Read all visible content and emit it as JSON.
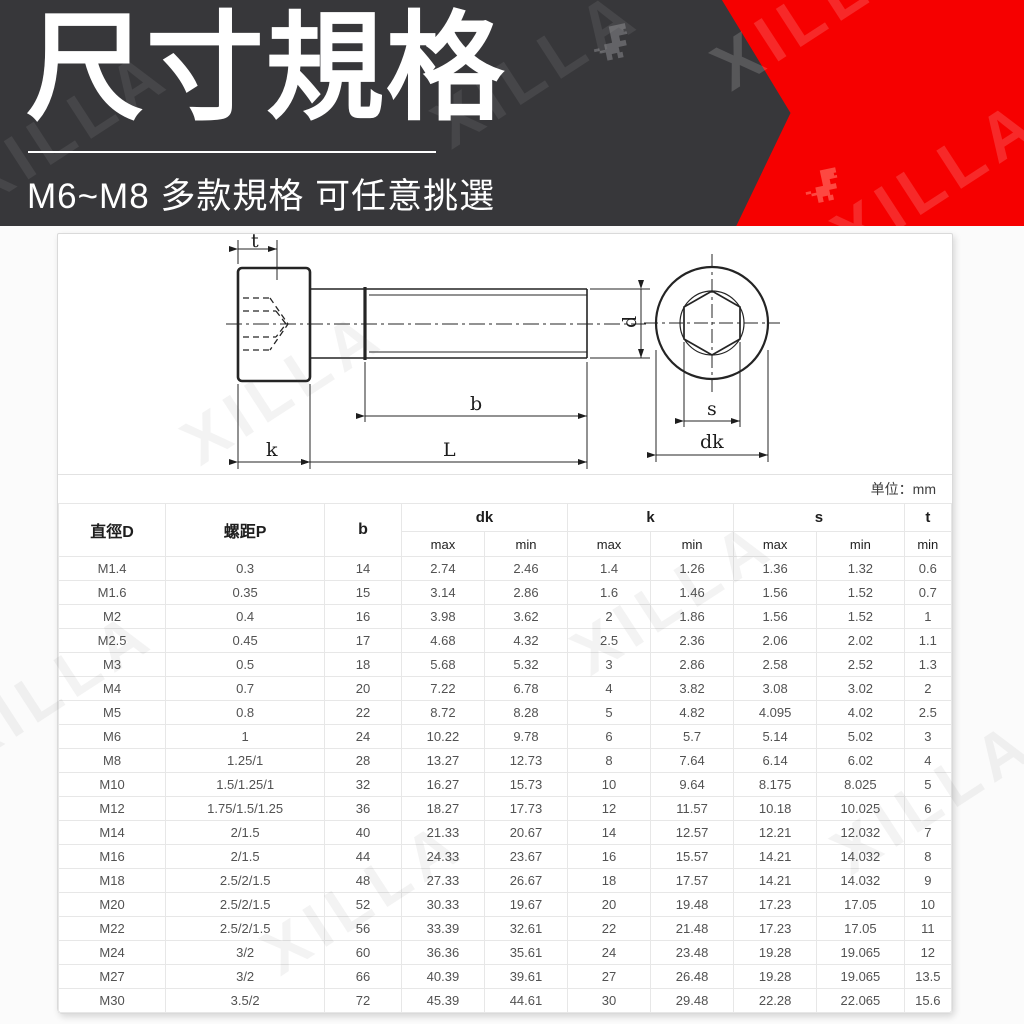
{
  "header": {
    "title": "尺寸規格",
    "subtitle": "M6~M8 多款規格 可任意挑選",
    "watermark_text": "XILLA",
    "colors": {
      "background": "#37373a",
      "accent_red": "#f60000",
      "title_text": "#ffffff"
    }
  },
  "drawing": {
    "dim_labels": {
      "t": "t",
      "d": "d",
      "b": "b",
      "k": "k",
      "L": "L",
      "s": "s",
      "dk": "dk"
    }
  },
  "table": {
    "unit_note": "单位：mm",
    "headers": {
      "diameter": "直徑D",
      "pitch": "螺距P",
      "b": "b",
      "dk": "dk",
      "k": "k",
      "s": "s",
      "t": "t",
      "max": "max",
      "min": "min"
    },
    "rows": [
      [
        "M1.4",
        "0.3",
        "14",
        "2.74",
        "2.46",
        "1.4",
        "1.26",
        "1.36",
        "1.32",
        "0.6"
      ],
      [
        "M1.6",
        "0.35",
        "15",
        "3.14",
        "2.86",
        "1.6",
        "1.46",
        "1.56",
        "1.52",
        "0.7"
      ],
      [
        "M2",
        "0.4",
        "16",
        "3.98",
        "3.62",
        "2",
        "1.86",
        "1.56",
        "1.52",
        "1"
      ],
      [
        "M2.5",
        "0.45",
        "17",
        "4.68",
        "4.32",
        "2.5",
        "2.36",
        "2.06",
        "2.02",
        "1.1"
      ],
      [
        "M3",
        "0.5",
        "18",
        "5.68",
        "5.32",
        "3",
        "2.86",
        "2.58",
        "2.52",
        "1.3"
      ],
      [
        "M4",
        "0.7",
        "20",
        "7.22",
        "6.78",
        "4",
        "3.82",
        "3.08",
        "3.02",
        "2"
      ],
      [
        "M5",
        "0.8",
        "22",
        "8.72",
        "8.28",
        "5",
        "4.82",
        "4.095",
        "4.02",
        "2.5"
      ],
      [
        "M6",
        "1",
        "24",
        "10.22",
        "9.78",
        "6",
        "5.7",
        "5.14",
        "5.02",
        "3"
      ],
      [
        "M8",
        "1.25/1",
        "28",
        "13.27",
        "12.73",
        "8",
        "7.64",
        "6.14",
        "6.02",
        "4"
      ],
      [
        "M10",
        "1.5/1.25/1",
        "32",
        "16.27",
        "15.73",
        "10",
        "9.64",
        "8.175",
        "8.025",
        "5"
      ],
      [
        "M12",
        "1.75/1.5/1.25",
        "36",
        "18.27",
        "17.73",
        "12",
        "11.57",
        "10.18",
        "10.025",
        "6"
      ],
      [
        "M14",
        "2/1.5",
        "40",
        "21.33",
        "20.67",
        "14",
        "12.57",
        "12.21",
        "12.032",
        "7"
      ],
      [
        "M16",
        "2/1.5",
        "44",
        "24.33",
        "23.67",
        "16",
        "15.57",
        "14.21",
        "14.032",
        "8"
      ],
      [
        "M18",
        "2.5/2/1.5",
        "48",
        "27.33",
        "26.67",
        "18",
        "17.57",
        "14.21",
        "14.032",
        "9"
      ],
      [
        "M20",
        "2.5/2/1.5",
        "52",
        "30.33",
        "19.67",
        "20",
        "19.48",
        "17.23",
        "17.05",
        "10"
      ],
      [
        "M22",
        "2.5/2/1.5",
        "56",
        "33.39",
        "32.61",
        "22",
        "21.48",
        "17.23",
        "17.05",
        "11"
      ],
      [
        "M24",
        "3/2",
        "60",
        "36.36",
        "35.61",
        "24",
        "23.48",
        "19.28",
        "19.065",
        "12"
      ],
      [
        "M27",
        "3/2",
        "66",
        "40.39",
        "39.61",
        "27",
        "26.48",
        "19.28",
        "19.065",
        "13.5"
      ],
      [
        "M30",
        "3.5/2",
        "72",
        "45.39",
        "44.61",
        "30",
        "29.48",
        "22.28",
        "22.065",
        "15.6"
      ]
    ]
  }
}
